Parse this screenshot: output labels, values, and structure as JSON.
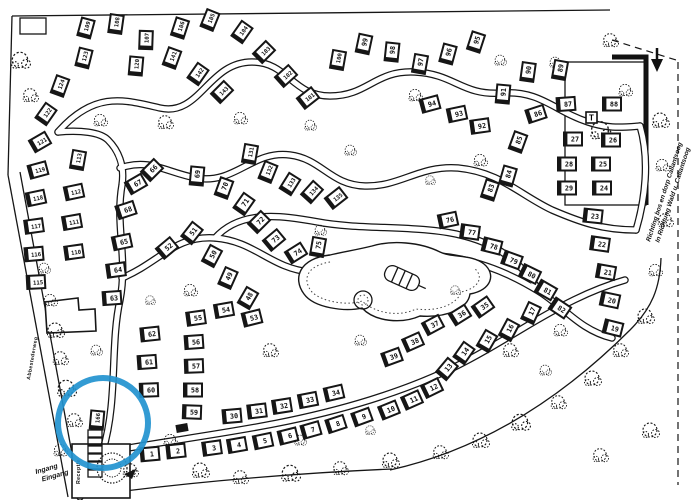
{
  "map": {
    "paper_color": "#ffffff",
    "ink_color": "#161616",
    "street_label": "Abbestederweg",
    "entrance_label": {
      "line1": "Ingang",
      "line2": "Eingang"
    },
    "reception_label": "Receptie",
    "direction_sign": {
      "line1": "Richting bos en dorp Callantsoog",
      "line2": "In Richtung Wald u. Callantsoog"
    },
    "t_marker": "T",
    "marker": {
      "lot": "166",
      "color": "#2293cf"
    },
    "lots": [
      {
        "n": "109",
        "x": 86,
        "y": 28,
        "a": -75
      },
      {
        "n": "108",
        "x": 116,
        "y": 24,
        "a": -82
      },
      {
        "n": "107",
        "x": 146,
        "y": 40,
        "a": -88
      },
      {
        "n": "106",
        "x": 180,
        "y": 28,
        "a": -72
      },
      {
        "n": "105",
        "x": 210,
        "y": 20,
        "a": -68
      },
      {
        "n": "104",
        "x": 242,
        "y": 32,
        "a": -55
      },
      {
        "n": "103",
        "x": 264,
        "y": 52,
        "a": -45
      },
      {
        "n": "102",
        "x": 286,
        "y": 76,
        "a": -42
      },
      {
        "n": "101",
        "x": 308,
        "y": 98,
        "a": -38
      },
      {
        "n": "100",
        "x": 338,
        "y": 60,
        "a": -80
      },
      {
        "n": "99",
        "x": 364,
        "y": 44,
        "a": -78
      },
      {
        "n": "98",
        "x": 392,
        "y": 52,
        "a": -84
      },
      {
        "n": "97",
        "x": 420,
        "y": 64,
        "a": -80
      },
      {
        "n": "96",
        "x": 448,
        "y": 54,
        "a": -75
      },
      {
        "n": "95",
        "x": 476,
        "y": 42,
        "a": -72
      },
      {
        "n": "94",
        "x": 430,
        "y": 104,
        "a": -15
      },
      {
        "n": "93",
        "x": 457,
        "y": 114,
        "a": -12
      },
      {
        "n": "92",
        "x": 480,
        "y": 126,
        "a": -8
      },
      {
        "n": "91",
        "x": 503,
        "y": 94,
        "a": -85
      },
      {
        "n": "90",
        "x": 528,
        "y": 72,
        "a": -82
      },
      {
        "n": "89",
        "x": 560,
        "y": 70,
        "a": -80
      },
      {
        "n": "88",
        "x": 612,
        "y": 104,
        "a": 0
      },
      {
        "n": "87",
        "x": 566,
        "y": 104,
        "a": -4
      },
      {
        "n": "86",
        "x": 536,
        "y": 114,
        "a": -18
      },
      {
        "n": "85",
        "x": 518,
        "y": 142,
        "a": -70
      },
      {
        "n": "84",
        "x": 508,
        "y": 176,
        "a": -74
      },
      {
        "n": "83",
        "x": 490,
        "y": 190,
        "a": -72
      },
      {
        "n": "27",
        "x": 573,
        "y": 139,
        "a": 0
      },
      {
        "n": "26",
        "x": 611,
        "y": 140,
        "a": 0
      },
      {
        "n": "28",
        "x": 567,
        "y": 164,
        "a": 0
      },
      {
        "n": "25",
        "x": 601,
        "y": 164,
        "a": 0
      },
      {
        "n": "29",
        "x": 567,
        "y": 188,
        "a": 0
      },
      {
        "n": "24",
        "x": 602,
        "y": 188,
        "a": 0
      },
      {
        "n": "23",
        "x": 593,
        "y": 216,
        "a": 6
      },
      {
        "n": "22",
        "x": 600,
        "y": 244,
        "a": 8
      },
      {
        "n": "21",
        "x": 606,
        "y": 272,
        "a": 10
      },
      {
        "n": "20",
        "x": 610,
        "y": 300,
        "a": 12
      },
      {
        "n": "19",
        "x": 613,
        "y": 328,
        "a": 14
      },
      {
        "n": "124",
        "x": 60,
        "y": 86,
        "a": -70
      },
      {
        "n": "123",
        "x": 84,
        "y": 58,
        "a": -76
      },
      {
        "n": "122",
        "x": 46,
        "y": 114,
        "a": -55
      },
      {
        "n": "121",
        "x": 40,
        "y": 142,
        "a": -30
      },
      {
        "n": "120",
        "x": 136,
        "y": 66,
        "a": -85
      },
      {
        "n": "141",
        "x": 172,
        "y": 58,
        "a": -70
      },
      {
        "n": "142",
        "x": 198,
        "y": 74,
        "a": -55
      },
      {
        "n": "143",
        "x": 222,
        "y": 92,
        "a": -45
      },
      {
        "n": "119",
        "x": 38,
        "y": 170,
        "a": -15
      },
      {
        "n": "118",
        "x": 36,
        "y": 198,
        "a": -12
      },
      {
        "n": "117",
        "x": 34,
        "y": 226,
        "a": -8
      },
      {
        "n": "116",
        "x": 34,
        "y": 254,
        "a": -5
      },
      {
        "n": "115",
        "x": 36,
        "y": 282,
        "a": -3
      },
      {
        "n": "113",
        "x": 78,
        "y": 160,
        "a": -80
      },
      {
        "n": "112",
        "x": 74,
        "y": 192,
        "a": -12
      },
      {
        "n": "111",
        "x": 72,
        "y": 222,
        "a": -10
      },
      {
        "n": "110",
        "x": 74,
        "y": 252,
        "a": -8
      },
      {
        "n": "131",
        "x": 250,
        "y": 154,
        "a": -80
      },
      {
        "n": "132",
        "x": 268,
        "y": 172,
        "a": -68
      },
      {
        "n": "133",
        "x": 290,
        "y": 184,
        "a": -58
      },
      {
        "n": "134",
        "x": 312,
        "y": 192,
        "a": -48
      },
      {
        "n": "135",
        "x": 336,
        "y": 198,
        "a": -38
      },
      {
        "n": "66",
        "x": 152,
        "y": 170,
        "a": -45
      },
      {
        "n": "67",
        "x": 136,
        "y": 184,
        "a": -30
      },
      {
        "n": "68",
        "x": 126,
        "y": 210,
        "a": -18
      },
      {
        "n": "65",
        "x": 122,
        "y": 242,
        "a": -12
      },
      {
        "n": "64",
        "x": 116,
        "y": 270,
        "a": -8
      },
      {
        "n": "63",
        "x": 112,
        "y": 298,
        "a": -4
      },
      {
        "n": "69",
        "x": 197,
        "y": 176,
        "a": -85
      },
      {
        "n": "70",
        "x": 224,
        "y": 188,
        "a": -70
      },
      {
        "n": "71",
        "x": 244,
        "y": 204,
        "a": -55
      },
      {
        "n": "72",
        "x": 259,
        "y": 222,
        "a": -45
      },
      {
        "n": "73",
        "x": 274,
        "y": 240,
        "a": -40
      },
      {
        "n": "74",
        "x": 296,
        "y": 253,
        "a": -32
      },
      {
        "n": "75",
        "x": 318,
        "y": 247,
        "a": -80
      },
      {
        "n": "76",
        "x": 448,
        "y": 220,
        "a": -12
      },
      {
        "n": "77",
        "x": 470,
        "y": 232,
        "a": 8
      },
      {
        "n": "78",
        "x": 492,
        "y": 246,
        "a": 14
      },
      {
        "n": "79",
        "x": 512,
        "y": 260,
        "a": 20
      },
      {
        "n": "80",
        "x": 530,
        "y": 274,
        "a": 26
      },
      {
        "n": "81",
        "x": 546,
        "y": 290,
        "a": 30
      },
      {
        "n": "82",
        "x": 560,
        "y": 308,
        "a": 34
      },
      {
        "n": "52",
        "x": 167,
        "y": 248,
        "a": -40
      },
      {
        "n": "51",
        "x": 192,
        "y": 233,
        "a": -52
      },
      {
        "n": "50",
        "x": 212,
        "y": 256,
        "a": -62
      },
      {
        "n": "49",
        "x": 228,
        "y": 278,
        "a": -66
      },
      {
        "n": "48",
        "x": 248,
        "y": 298,
        "a": -60
      },
      {
        "n": "55",
        "x": 196,
        "y": 318,
        "a": -8
      },
      {
        "n": "54",
        "x": 224,
        "y": 310,
        "a": -10
      },
      {
        "n": "53",
        "x": 252,
        "y": 318,
        "a": -14
      },
      {
        "n": "62",
        "x": 150,
        "y": 334,
        "a": -6
      },
      {
        "n": "61",
        "x": 147,
        "y": 362,
        "a": -4
      },
      {
        "n": "60",
        "x": 149,
        "y": 390,
        "a": -2
      },
      {
        "n": "56",
        "x": 194,
        "y": 342,
        "a": -4
      },
      {
        "n": "57",
        "x": 194,
        "y": 366,
        "a": -2
      },
      {
        "n": "58",
        "x": 193,
        "y": 390,
        "a": 0
      },
      {
        "n": "59",
        "x": 192,
        "y": 412,
        "a": 2
      },
      {
        "n": "30",
        "x": 232,
        "y": 416,
        "a": -5
      },
      {
        "n": "31",
        "x": 257,
        "y": 411,
        "a": -7
      },
      {
        "n": "32",
        "x": 282,
        "y": 406,
        "a": -9
      },
      {
        "n": "33",
        "x": 308,
        "y": 400,
        "a": -11
      },
      {
        "n": "34",
        "x": 334,
        "y": 393,
        "a": -13
      },
      {
        "n": "39",
        "x": 392,
        "y": 357,
        "a": -20
      },
      {
        "n": "38",
        "x": 413,
        "y": 342,
        "a": -24
      },
      {
        "n": "37",
        "x": 433,
        "y": 325,
        "a": -28
      },
      {
        "n": "36",
        "x": 460,
        "y": 315,
        "a": -32
      },
      {
        "n": "35",
        "x": 483,
        "y": 307,
        "a": -35
      },
      {
        "n": "1",
        "x": 150,
        "y": 454,
        "a": -5
      },
      {
        "n": "2",
        "x": 176,
        "y": 451,
        "a": -6
      },
      {
        "n": "3",
        "x": 212,
        "y": 448,
        "a": -8
      },
      {
        "n": "4",
        "x": 237,
        "y": 445,
        "a": -10
      },
      {
        "n": "5",
        "x": 263,
        "y": 441,
        "a": -12
      },
      {
        "n": "6",
        "x": 288,
        "y": 436,
        "a": -14
      },
      {
        "n": "7",
        "x": 311,
        "y": 430,
        "a": -16
      },
      {
        "n": "8",
        "x": 336,
        "y": 424,
        "a": -18
      },
      {
        "n": "9",
        "x": 362,
        "y": 417,
        "a": -20
      },
      {
        "n": "10",
        "x": 389,
        "y": 410,
        "a": -22
      },
      {
        "n": "11",
        "x": 412,
        "y": 400,
        "a": -24
      },
      {
        "n": "12",
        "x": 432,
        "y": 388,
        "a": -26
      },
      {
        "n": "13",
        "x": 447,
        "y": 369,
        "a": -50
      },
      {
        "n": "14",
        "x": 464,
        "y": 353,
        "a": -55
      },
      {
        "n": "15",
        "x": 487,
        "y": 341,
        "a": -60
      },
      {
        "n": "16",
        "x": 509,
        "y": 330,
        "a": -62
      },
      {
        "n": "17",
        "x": 531,
        "y": 313,
        "a": -65
      },
      {
        "n": "166",
        "x": 97,
        "y": 420,
        "a": -85
      }
    ],
    "trees": [
      [
        20,
        60,
        1.1
      ],
      [
        30,
        95,
        0.9
      ],
      [
        55,
        330,
        1
      ],
      [
        60,
        358,
        0.9
      ],
      [
        66,
        388,
        1.1
      ],
      [
        74,
        420,
        0.9
      ],
      [
        50,
        300,
        0.8
      ],
      [
        44,
        268,
        0.7
      ],
      [
        100,
        120,
        0.8
      ],
      [
        165,
        122,
        0.9
      ],
      [
        240,
        118,
        0.8
      ],
      [
        310,
        125,
        0.7
      ],
      [
        415,
        95,
        0.8
      ],
      [
        500,
        60,
        0.7
      ],
      [
        610,
        40,
        0.9
      ],
      [
        660,
        120,
        1
      ],
      [
        662,
        165,
        0.8
      ],
      [
        480,
        160,
        0.8
      ],
      [
        555,
        62,
        0.7
      ],
      [
        350,
        150,
        0.7
      ],
      [
        430,
        180,
        0.6
      ],
      [
        190,
        290,
        0.8
      ],
      [
        270,
        350,
        0.9
      ],
      [
        320,
        230,
        0.7
      ],
      [
        455,
        290,
        0.6
      ],
      [
        360,
        340,
        0.7
      ],
      [
        200,
        470,
        1
      ],
      [
        240,
        477,
        0.9
      ],
      [
        290,
        473,
        1.1
      ],
      [
        340,
        468,
        0.9
      ],
      [
        390,
        460,
        1
      ],
      [
        440,
        452,
        0.9
      ],
      [
        480,
        440,
        1
      ],
      [
        520,
        422,
        1.1
      ],
      [
        558,
        402,
        0.9
      ],
      [
        592,
        378,
        1
      ],
      [
        620,
        350,
        0.9
      ],
      [
        645,
        316,
        1
      ],
      [
        655,
        270,
        0.8
      ],
      [
        510,
        350,
        0.9
      ],
      [
        560,
        330,
        0.8
      ],
      [
        600,
        130,
        1.2
      ],
      [
        625,
        90,
        0.8
      ],
      [
        150,
        300,
        0.6
      ],
      [
        96,
        350,
        0.7
      ],
      [
        170,
        440,
        0.8
      ],
      [
        130,
        470,
        0.9
      ],
      [
        60,
        450,
        0.8
      ],
      [
        665,
        220,
        0.9
      ],
      [
        650,
        430,
        1
      ],
      [
        600,
        455,
        0.9
      ],
      [
        545,
        370,
        0.7
      ],
      [
        300,
        440,
        0.7
      ],
      [
        370,
        430,
        0.6
      ]
    ]
  }
}
